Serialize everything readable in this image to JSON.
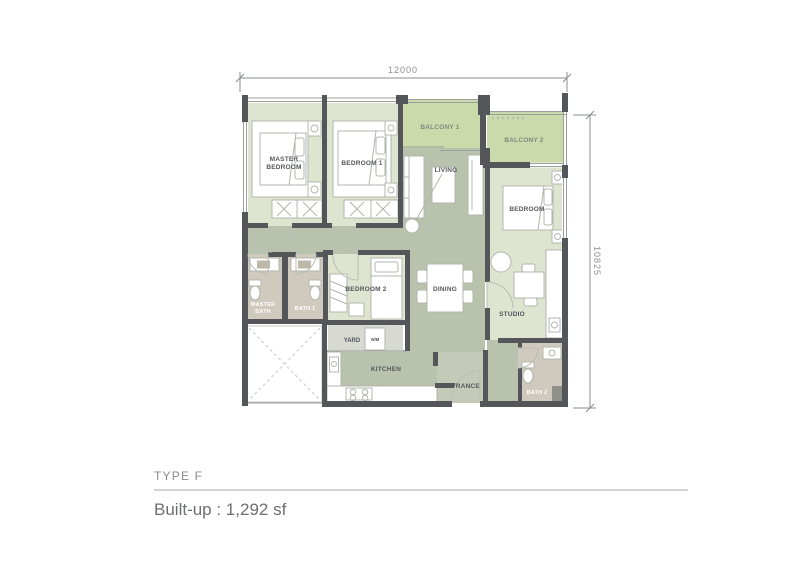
{
  "plan": {
    "dim_top": "12000",
    "dim_right": "10825",
    "rooms": {
      "master_bedroom": {
        "line1": "MASTER",
        "line2": "BEDROOM"
      },
      "bedroom1": {
        "label": "BEDROOM 1"
      },
      "balcony1": {
        "label": "BALCONY 1"
      },
      "balcony2": {
        "label": "BALCONY 2"
      },
      "living": {
        "label": "LIVING"
      },
      "bedroom": {
        "label": "BEDROOM"
      },
      "bedroom2": {
        "label": "BEDROOM 2"
      },
      "dining": {
        "label": "DINING"
      },
      "studio": {
        "label": "STUDIO"
      },
      "master_bath": {
        "line1": "MASTER",
        "line2": "BATH"
      },
      "bath1": {
        "label": "BATH 1"
      },
      "bath2": {
        "label": "BATH 2"
      },
      "yard": {
        "label": "YARD"
      },
      "kitchen": {
        "label": "KITCHEN"
      },
      "entrance": {
        "label": "ENTRANCE"
      },
      "washing_machine": {
        "label": "W/M"
      }
    },
    "colors": {
      "wall": "#55565a",
      "room_fill": "#dfe4d1",
      "open_area_fill": "#b8c2ad",
      "balcony_fill": "#cbdaab",
      "bath_fill": "#cfc9be",
      "yard_fill": "#d8dad1",
      "entrance_fill": "#c3cab8",
      "label_text": "#55565b",
      "dimension_gray": "#8b8c8f"
    }
  },
  "footer": {
    "type_label": "TYPE F",
    "builtup_label": "Built-up : 1,292 sf"
  }
}
